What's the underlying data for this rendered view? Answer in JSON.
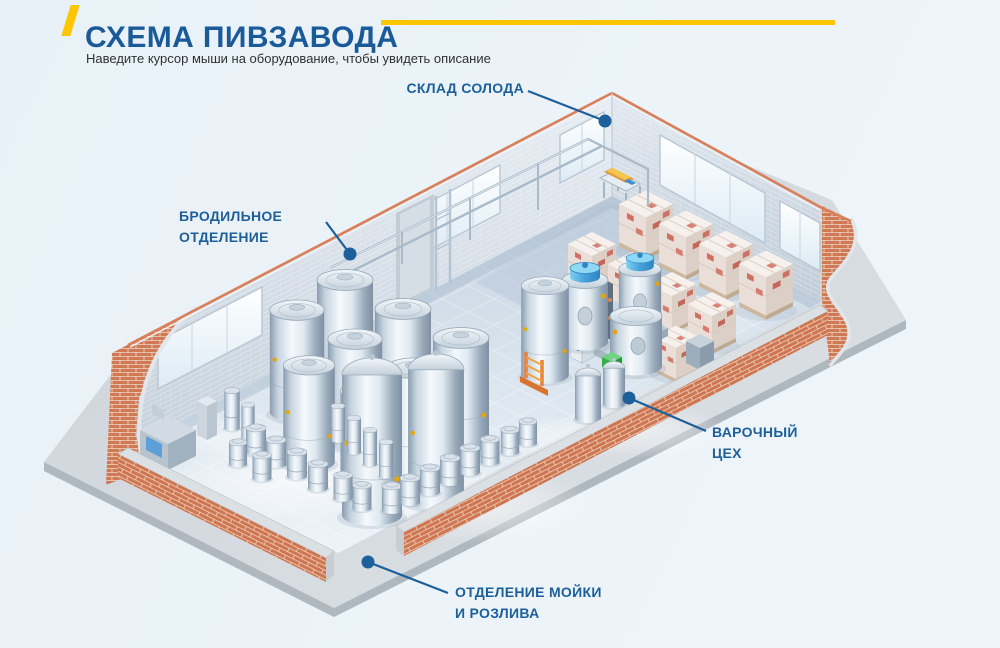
{
  "header": {
    "title": "СХЕМА ПИВЗАВОДА",
    "subtitle": "Наведите курсор мыши на оборудование, чтобы увидеть описание"
  },
  "labels": {
    "malt_warehouse": "СКЛАД СОЛОДА",
    "fermentation": "БРОДИЛЬНОЕ\nОТДЕЛЕНИЕ",
    "brewhouse": "ВАРОЧНЫЙ\nЦЕХ",
    "washing_bottling": "ОТДЕЛЕНИЕ МОЙКИ\nИ РОЗЛИВА"
  },
  "colors": {
    "accent_blue": "#1d5f9b",
    "title_blue": "#1a5a99",
    "accent_yellow": "#ffc600",
    "brick": "#d07a55",
    "background": "#eaf2f7"
  }
}
